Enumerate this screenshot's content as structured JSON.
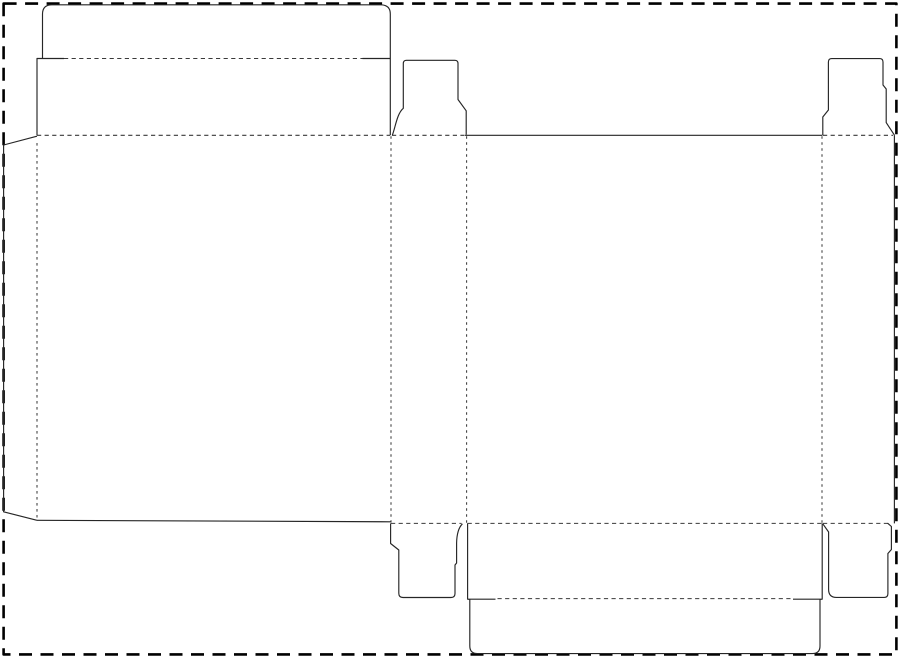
{
  "colors": {
    "background": "#ffffff",
    "border": "#000000",
    "cut": "#262626",
    "fold": "#3a3a3a"
  },
  "strokes": {
    "border_width": 2.6,
    "border_dash": "13 8.5",
    "cut_width": 1.15,
    "fold_width": 1.05,
    "fold_dash_horizontal": "4.2 3.4",
    "fold_dash_vertical": "2.6 3.4"
  },
  "paths": {
    "sheet_border": "M3.6,3.6 H896.4 V654.4 H3.6 Z",
    "tuck_flap_top": "M37,135.3 L37,58.5 L42.5,58.5 L42.5,14 Q42.5,4.8 52,4.8 L380.5,4.8 Q390.3,4.8 390.3,14 L390.3,135.3 M37,58.5 L64,58.5 M362.5,58.5 L390.3,58.5",
    "tuck_fold_top": "M64,58.5 L362.5,58.5",
    "dust_tab_top_b": "M392.3,135.3 C395.5,127 397,113.5 403.3,108.3 L403.3,63.5 Q403.3,60.3 406.5,60.3 L454.8,60.3 Q458,60.3 458,63.5 L458,99.5 L466.2,110.8 L466.2,134.8",
    "dust_tab_top_d": "M822.8,135.3 L822.8,117 L828.4,110 L828.4,62 Q828.4,58.6 831.8,58.6 L879.6,58.6 Q883,58.6 883,62 L883,85 L886.2,89 L886.2,122.6 L894.4,135.1",
    "panel_c_top_cut": "M464.5,135.3 L822.3,135.3",
    "panel_d_right_cut": "M894.4,135.1 L894.4,523.4",
    "dust_flap_left": "M37,136.2 L3.6,145 L3.6,511.8 L37,520.3",
    "panel_a_bottom_cut": "M37,520.3 L391,521.8",
    "fold_row_top": "M37,135.3 L390,135.3 M392,135.3 L464,135.3 M823,135.3 L893,135.3",
    "fold_row_bottom": "M391,523.4 L461.5,523.4 M467.6,523.4 L822,523.4 M823,523.4 L890,523.4",
    "vertical_folds": "M37,143 L37,517.5 M391,136.2 L391,522.5 M466.6,136.2 L466.6,522.8 M822,136.2 L822,522.8",
    "dust_tab_bottom_b": "M390.6,523.4 L390.6,543.5 L398.8,550 L398.8,593.3 Q398.8,597.5 403,597.5 L451,597.5 Q455,597.5 455,593.5 L455,565 L456.6,563 L456.6,543 C456.8,533.5 458.6,527.6 462.4,523.8",
    "seal_flap_bottom_c": "M467.6,523.4 L467.6,599.2 L495.5,599.2 M467.6,599.2 L469.8,599.4 L469.8,646 Q469.8,653.6 477.5,653.6 L812.3,653.6 Q820,653.6 820,646 L820,599.4 L822.2,599.2 L822.2,523.4 M793,599.2 L822.2,599.2",
    "tuck_fold_bottom": "M497.5,598.6 L790.5,598.6",
    "dust_tab_bottom_d": "M822.8,523.8 L828.6,532 L828.6,589.5 Q828.6,597.4 836.4,597.4 L884.2,597.4 Q887.9,597.4 887.9,593.6 L887.9,553.5 L891.4,549.5 L891.4,526.5 L887.6,523.2"
  }
}
